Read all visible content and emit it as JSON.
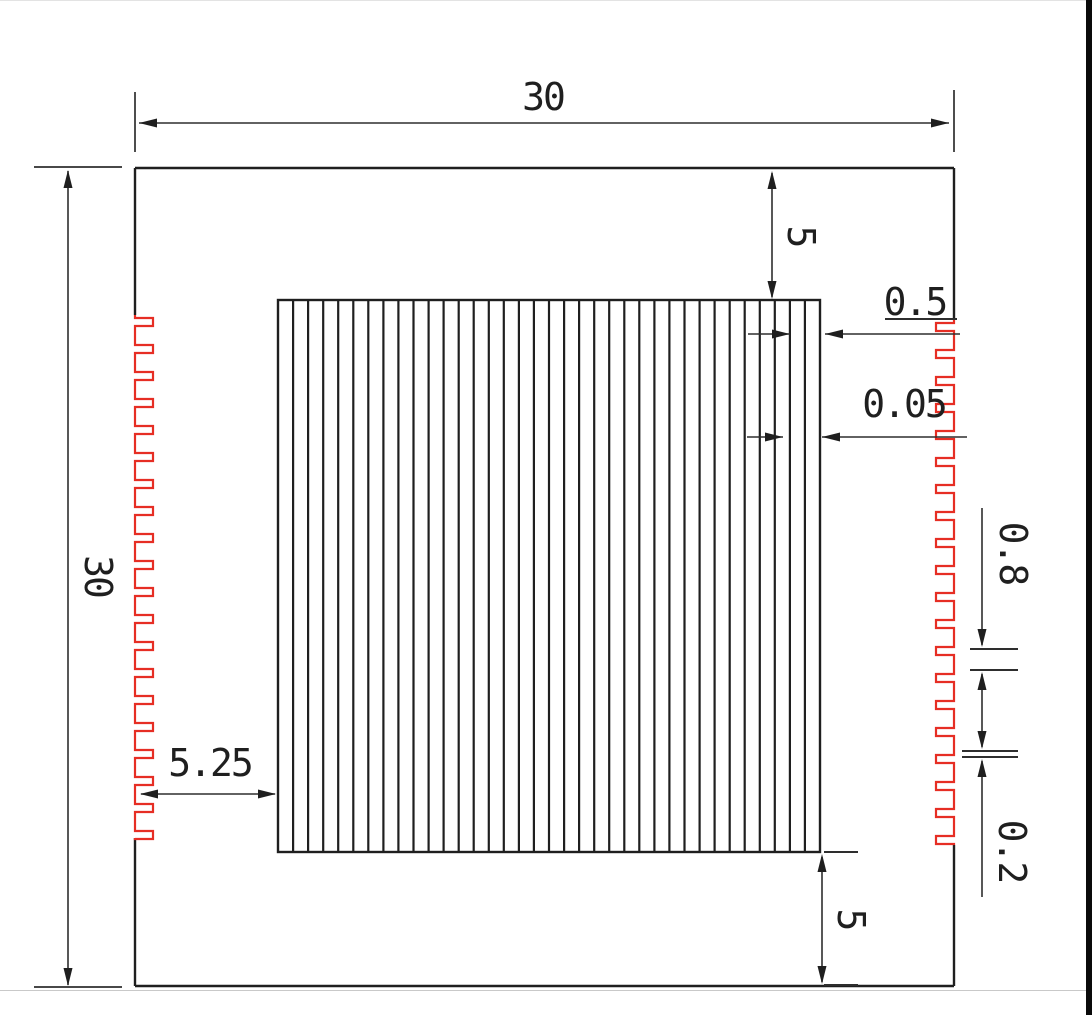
{
  "drawing": {
    "title": "serrated plate with grating - dimensioned drawing",
    "dimensions": {
      "overall_width": "30",
      "overall_height": "30",
      "grating_top_offset": "5",
      "grating_bottom_offset": "5",
      "grating_left_offset": "5.25",
      "slot_pitch": "0.5",
      "slot_line_width": "0.05",
      "serration_pitch": "0.8",
      "serration_tooth": "0.2"
    },
    "colors": {
      "line": "#1f1f1f",
      "dimension": "#2e2e2e",
      "serration_red": "#e62e24",
      "background": "#ffffff",
      "frame": "#0a0a0a"
    }
  }
}
